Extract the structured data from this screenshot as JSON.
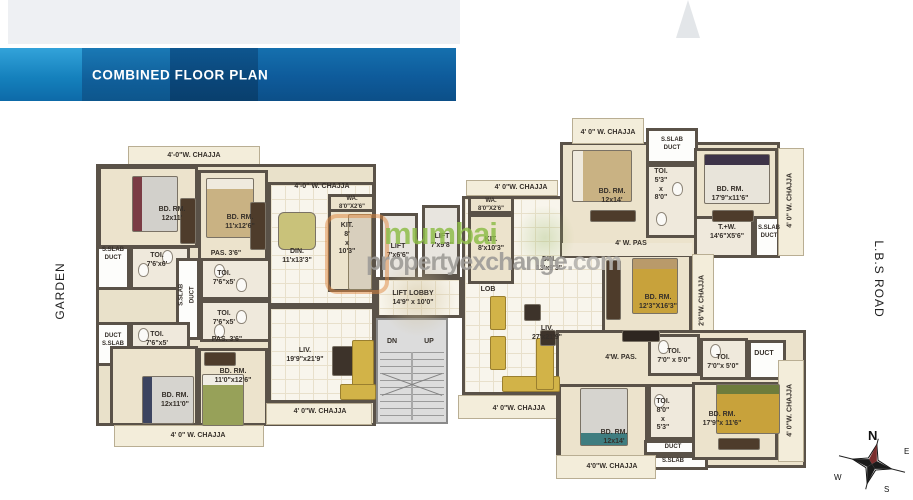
{
  "header": {
    "title": "COMBINED FLOOR PLAN"
  },
  "watermark": {
    "brand": "mumbai",
    "domain": "propertyexchange",
    "tld": ".com"
  },
  "surroundings": {
    "left": "GARDEN",
    "right": "L.B.S ROAD"
  },
  "compass": {
    "n": "N",
    "e": "E",
    "w": "W",
    "s": "S"
  },
  "core": {
    "lift1": "LIFT\n7'x6'6\"",
    "lift2": "LIFT\n7'x9'8\"",
    "lobby": "LIFT LOBBY\n14'9\" x 10'0\"",
    "dn": "DN",
    "up": "UP"
  },
  "left": {
    "chajja_top": "4'-0\"W. CHAJJA",
    "chajja_din": "4'-0\" W. CHAJJA",
    "bdrm1": "BD. RM.\n12x11'",
    "bdrm2": "BD. RM.\n11'x12'6\"",
    "sslab_top": "S.SLAB\nDUCT",
    "toi_top": "TOI.\n7'6'x6'",
    "pas_top": "PAS. 3'6\"",
    "sslab_v": "S.SLAB",
    "duct_v": "DUCT",
    "toi_m1": "TOI.\n7'6\"x5'",
    "toi_m2": "TOI.\n7'6\"x5'",
    "pas_bot": "PAS. 3'6\"",
    "duct_bot": "DUCT\nS.SLAB",
    "toi_bot": "TOI.\n7'6\"x5'",
    "bdrm3": "BD. RM.\n12x11'0\"",
    "bdrm4": "BD. RM.\n11'0\"x12'6\"",
    "chajja_b1": "4' 0\" W. CHAJJA",
    "chajja_b2": "4' 0\"W. CHAJJA",
    "wa": "WA.\n8'0\"X2'6\"",
    "kit": "KIT.\n8'\nx\n10'3\"",
    "din": "DIN.\n11'x13'3\"",
    "liv": "LIV.\n19'9\"x21'9\""
  },
  "right": {
    "chajja_entry": "4' 0\"W. CHAJJA",
    "wa": "WA.\n8'0\"X2'6\"",
    "kit": "KIT.\n8'x10'3\"",
    "din": "DIN.\n13'x9'3\"",
    "lob": "LOB",
    "liv": "LIV.\n27'x21'9\"",
    "chajja_liv": "4' 0\"W. CHAJJA",
    "chajja_top": "4' 0\" W. CHAJJA",
    "bdrm_t": "BD. RM.\n12x14'",
    "sslab_t": "S.SLAB\nDUCT",
    "toi_t": "TOI.\n5'3\"\nx\n8'0\"",
    "bdrm_tr": "BD. RM.\n17'9\"x11'6\"",
    "chajja_rt": "4' 0\" W. CHAJJA",
    "pas_t": "4' W. PAS",
    "tw": "T.+W.\n14'6\"X5'6\"",
    "sslab_r": "S.SLAB\nDUCT",
    "bdrm_m": "BD. RM.\n12'3\"X16'3\"",
    "chajja_m": "2'6\"W. CHAJJA",
    "pas_b": "4'W. PAS.",
    "toi_b1": "TOI.\n7'0\" x 5'0\"",
    "toi_b2": "TOI.\n7'0\"x 5'0\"",
    "duct_b1": "DUCT",
    "bdrm_bl": "BD. RM.\n12x14'",
    "toi_bl": "TOI.\n8'0\"\nx\n5'3\"",
    "duct_b2": "DUCT",
    "sslab_b": "S.SLAB",
    "bdrm_br": "BD. RM.\n17'9\"x 11'6\"",
    "chajja_rb": "4' 0\"W. CHAJJA",
    "chajja_bot": "4'0\"W. CHAJJA"
  },
  "colors": {
    "banner_blue_light": "#33a3da",
    "banner_blue_mid": "#105f9a",
    "banner_blue_dark": "#0a4679",
    "wall": "#5a5248",
    "room_fill": "#ece3cc",
    "sofa_yellow": "#d2b348",
    "watermark_green": "#8fbe4a",
    "watermark_gray": "#9e9c98",
    "logo_orange": "#e0873f"
  }
}
